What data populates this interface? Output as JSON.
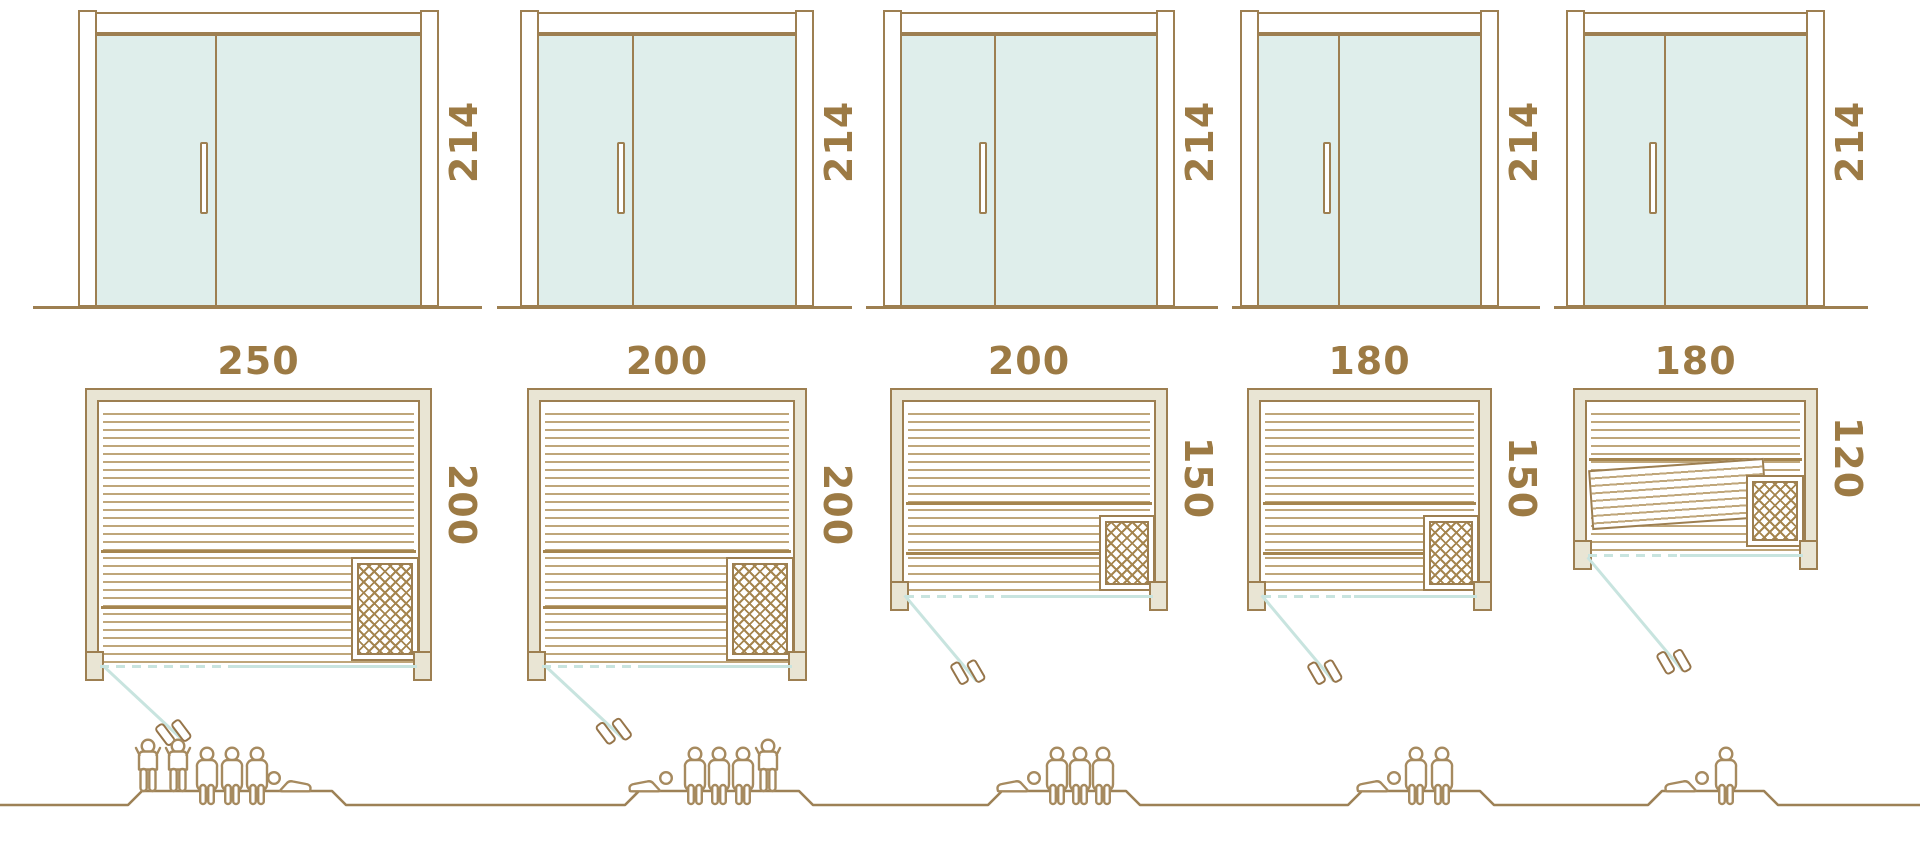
{
  "units": [
    {
      "door_height": "214",
      "width": "250",
      "depth": "200",
      "occupants": [
        "standing",
        "standing",
        "sitting",
        "sitting",
        "sitting",
        "lying"
      ],
      "people_count": 6
    },
    {
      "door_height": "214",
      "width": "200",
      "depth": "200",
      "occupants": [
        "lying",
        "sitting",
        "sitting",
        "sitting",
        "standing"
      ],
      "people_count": 5
    },
    {
      "door_height": "214",
      "width": "200",
      "depth": "150",
      "occupants": [
        "lying",
        "sitting",
        "sitting",
        "sitting"
      ],
      "people_count": 4
    },
    {
      "door_height": "214",
      "width": "180",
      "depth": "150",
      "occupants": [
        "lying",
        "sitting",
        "sitting"
      ],
      "people_count": 3
    },
    {
      "door_height": "214",
      "width": "180",
      "depth": "120",
      "occupants": [
        "lying",
        "sitting"
      ],
      "people_count": 2
    }
  ],
  "colors": {
    "outline_brown": "#9d7f51",
    "dimension_text": "#9c7a44",
    "frame_beige": "#e9e5d4",
    "glass_mint": "#dfeeeb",
    "door_teal": "#c8e4df",
    "people_outline": "#a68a5f"
  }
}
